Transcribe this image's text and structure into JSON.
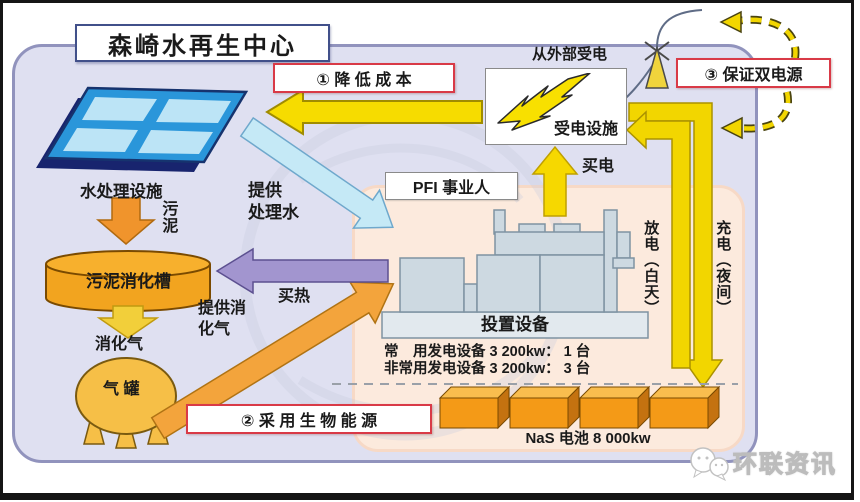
{
  "title": "森崎水再生中心",
  "callouts": {
    "one": "① 降 低 成 本",
    "two": "② 采 用 生 物 能 源",
    "three": "③ 保证双电源"
  },
  "power": {
    "external": "从外部受电",
    "receiving": "受电设施",
    "buy": "买电",
    "discharge": "放电（白天）",
    "charge": "充电（夜间）"
  },
  "pfi": {
    "label": "PFI 事业人",
    "equipment": "投置设备",
    "spec_normal": "常　用发电设备 3 200kw：  1 台",
    "spec_emergency": "非常用发电设备 3 200kw：  3 台",
    "nas": "NaS 电池  8 000kw"
  },
  "water": {
    "facility": "水处理设施",
    "sludge": "污泥",
    "treated_line1": "提供",
    "treated_line2": "处理水"
  },
  "bio": {
    "tank": "污泥消化槽",
    "gas": "消化气",
    "gas_tank": "气 罐",
    "provide_line1": "提供消",
    "provide_line2": "化气",
    "buy_heat": "买热"
  },
  "brand": {
    "name": "环联资讯"
  },
  "colors": {
    "accent_red": "#d93a47",
    "arrow_yellow": "#f2d600",
    "arrow_orange": "#f3a43c",
    "arrow_purple": "#a295cf",
    "arrow_cyan": "#c5e9f6",
    "panel_blue": "#2a96da",
    "battery_orange": "#f49a17",
    "outer_fill": "#dfe0f1",
    "inner_fill": "#fceadd"
  }
}
